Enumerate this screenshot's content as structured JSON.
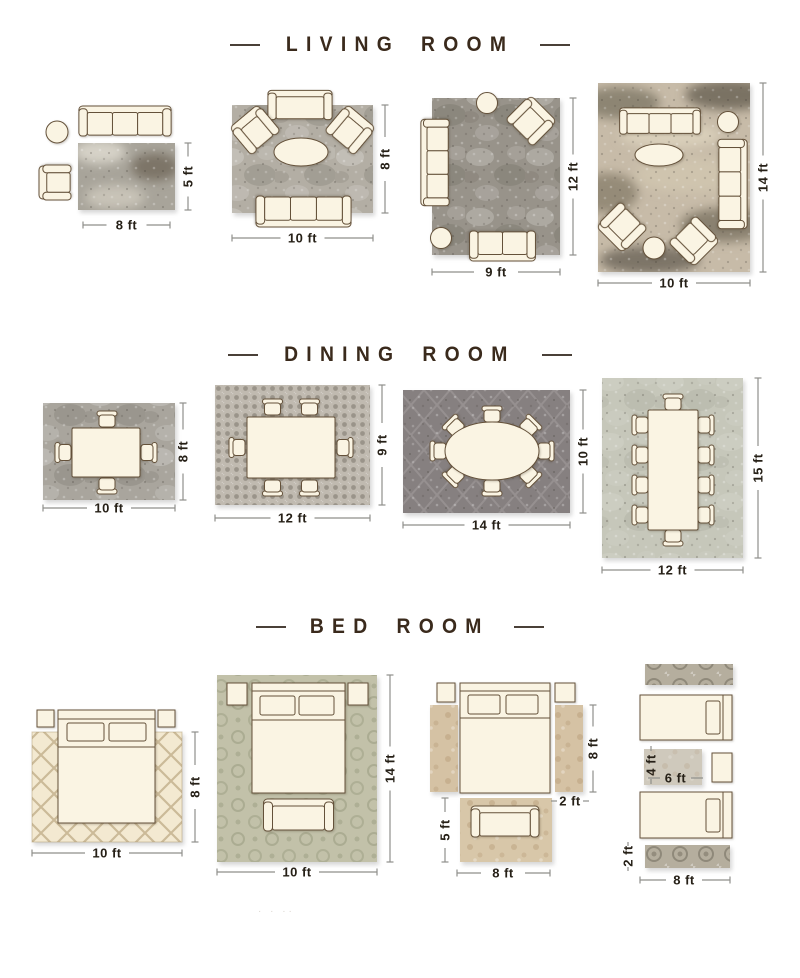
{
  "sections": {
    "living": {
      "title": "LIVING ROOM",
      "layouts": {
        "l1": {
          "w": "8 ft",
          "h": "5 ft"
        },
        "l2": {
          "w": "10 ft",
          "h": "8 ft"
        },
        "l3": {
          "w": "9 ft",
          "h": "12 ft"
        },
        "l4": {
          "w": "10 ft",
          "h": "14 ft"
        }
      }
    },
    "dining": {
      "title": "DINING ROOM",
      "layouts": {
        "l1": {
          "w": "10 ft",
          "h": "8 ft"
        },
        "l2": {
          "w": "12 ft",
          "h": "9 ft"
        },
        "l3": {
          "w": "14 ft",
          "h": "10 ft"
        },
        "l4": {
          "w": "12 ft",
          "h": "15 ft"
        }
      }
    },
    "bedroom": {
      "title": "BED ROOM",
      "layouts": {
        "l1": {
          "w": "10 ft",
          "h": "8 ft"
        },
        "l2": {
          "w": "10 ft",
          "h": "14 ft"
        },
        "l3": {
          "bed_side_h": "8 ft",
          "runner_w": "2 ft",
          "foot_rug_h": "5 ft",
          "foot_rug_w": "8 ft"
        },
        "l4": {
          "runner_h": "2 ft",
          "mid_rug_h": "4 ft",
          "mid_rug_w": "6 ft",
          "w": "8 ft"
        }
      }
    }
  },
  "colors": {
    "background": "#ffffff",
    "title_text": "#3a2a1c",
    "dimension_text": "#262017",
    "dimension_line": "#8f8f8b",
    "furniture_fill": "#faf4e3",
    "furniture_outline": "#64513a",
    "rug_gray": "#a8a49a",
    "rug_dark_gray": "#868080",
    "rug_cream": "#f3e9d1",
    "rug_sage": "#c2c1a9",
    "rug_tan": "#d5c2a4"
  },
  "faint_marks": "· · ··"
}
